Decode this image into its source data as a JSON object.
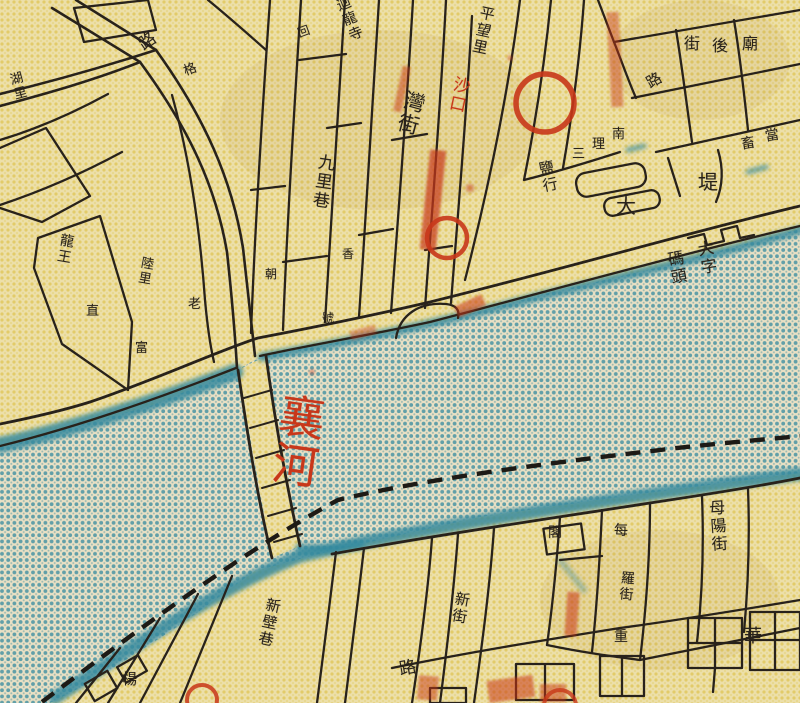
{
  "colors": {
    "paper": "#ecdfa9",
    "halftone_yellow_dot": "#dcbe3e",
    "river_base": "#e9e0c4",
    "river_dot_teal": "#3e8ea1",
    "bank_wash_teal": "#35899e",
    "ink_black": "#28221b",
    "annotation_red": "#c8371a"
  },
  "annotations": {
    "red_circles": [
      {
        "x": 545,
        "y": 103,
        "r": 29
      },
      {
        "x": 447,
        "y": 238,
        "r": 20
      },
      {
        "x": 202,
        "y": 700,
        "r": 15
      },
      {
        "x": 560,
        "y": 706,
        "r": 16
      }
    ]
  },
  "labels": [
    {
      "t": "路",
      "x": 136,
      "y": 40,
      "o": "h",
      "s": 17,
      "c": "ink",
      "r": -35
    },
    {
      "t": "回",
      "x": 296,
      "y": 28,
      "o": "h",
      "s": 12,
      "c": "ink",
      "r": -20
    },
    {
      "t": "迴龍寺",
      "x": 333,
      "y": 0,
      "o": "v",
      "s": 14,
      "c": "ink",
      "r": -22
    },
    {
      "t": "格",
      "x": 182,
      "y": 66,
      "o": "h",
      "s": 13,
      "c": "ink",
      "r": -20
    },
    {
      "t": "平望里",
      "x": 480,
      "y": 4,
      "o": "v",
      "s": 15,
      "c": "ink",
      "r": 12
    },
    {
      "t": "灣街",
      "x": 405,
      "y": 88,
      "o": "v",
      "s": 21,
      "c": "ink",
      "r": 15
    },
    {
      "t": "沙口",
      "x": 452,
      "y": 74,
      "o": "v",
      "s": 17,
      "c": "red",
      "r": 12
    },
    {
      "t": "九里巷",
      "x": 316,
      "y": 152,
      "o": "v",
      "s": 17,
      "c": "ink",
      "r": 8
    },
    {
      "t": "湖里",
      "x": 6,
      "y": 74,
      "o": "v",
      "s": 13,
      "c": "ink",
      "r": -15
    },
    {
      "t": "龍王",
      "x": 60,
      "y": 232,
      "o": "v",
      "s": 14,
      "c": "ink",
      "r": 10
    },
    {
      "t": "直",
      "x": 86,
      "y": 305,
      "o": "h",
      "s": 13,
      "c": "ink",
      "r": 0
    },
    {
      "t": "陸里",
      "x": 140,
      "y": 255,
      "o": "v",
      "s": 13,
      "c": "ink",
      "r": 10
    },
    {
      "t": "老",
      "x": 188,
      "y": 298,
      "o": "h",
      "s": 13,
      "c": "ink",
      "r": 0
    },
    {
      "t": "富",
      "x": 135,
      "y": 342,
      "o": "h",
      "s": 13,
      "c": "ink",
      "r": 0
    },
    {
      "t": "朝",
      "x": 265,
      "y": 268,
      "o": "h",
      "s": 12,
      "c": "ink",
      "r": 0
    },
    {
      "t": "香",
      "x": 342,
      "y": 248,
      "o": "h",
      "s": 12,
      "c": "ink",
      "r": 0
    },
    {
      "t": "號",
      "x": 322,
      "y": 312,
      "o": "h",
      "s": 12,
      "c": "ink",
      "r": 0
    },
    {
      "t": "街",
      "x": 684,
      "y": 36,
      "o": "h",
      "s": 16,
      "c": "ink",
      "r": 0
    },
    {
      "t": "後",
      "x": 712,
      "y": 38,
      "o": "h",
      "s": 16,
      "c": "ink",
      "r": 0
    },
    {
      "t": "廟",
      "x": 742,
      "y": 36,
      "o": "h",
      "s": 16,
      "c": "ink",
      "r": 0
    },
    {
      "t": "路",
      "x": 644,
      "y": 78,
      "o": "h",
      "s": 15,
      "c": "ink",
      "r": -30
    },
    {
      "t": "畜",
      "x": 740,
      "y": 138,
      "o": "h",
      "s": 14,
      "c": "ink",
      "r": -10
    },
    {
      "t": "當",
      "x": 764,
      "y": 130,
      "o": "h",
      "s": 14,
      "c": "ink",
      "r": -10
    },
    {
      "t": "南",
      "x": 612,
      "y": 128,
      "o": "h",
      "s": 13,
      "c": "ink",
      "r": 0
    },
    {
      "t": "理",
      "x": 592,
      "y": 138,
      "o": "h",
      "s": 13,
      "c": "ink",
      "r": 0
    },
    {
      "t": "三",
      "x": 572,
      "y": 148,
      "o": "h",
      "s": 13,
      "c": "ink",
      "r": 0
    },
    {
      "t": "鹽行",
      "x": 536,
      "y": 162,
      "o": "v",
      "s": 15,
      "c": "ink",
      "r": -12
    },
    {
      "t": "大",
      "x": 616,
      "y": 196,
      "o": "h",
      "s": 20,
      "c": "ink",
      "r": 0
    },
    {
      "t": "堤",
      "x": 698,
      "y": 172,
      "o": "h",
      "s": 20,
      "c": "ink",
      "r": 0
    },
    {
      "t": "大字",
      "x": 694,
      "y": 242,
      "o": "v",
      "s": 16,
      "c": "ink",
      "r": -10
    },
    {
      "t": "碼頭",
      "x": 664,
      "y": 252,
      "o": "v",
      "s": 16,
      "c": "ink",
      "r": -10
    },
    {
      "t": "襄河",
      "x": 278,
      "y": 390,
      "o": "v",
      "s": 46,
      "c": "red",
      "r": 8
    },
    {
      "t": "母陽街",
      "x": 706,
      "y": 500,
      "o": "v",
      "s": 16,
      "c": "ink",
      "r": -4
    },
    {
      "t": "閣",
      "x": 548,
      "y": 526,
      "o": "h",
      "s": 14,
      "c": "ink",
      "r": 0
    },
    {
      "t": "每",
      "x": 614,
      "y": 524,
      "o": "h",
      "s": 14,
      "c": "ink",
      "r": 0
    },
    {
      "t": "羅街",
      "x": 620,
      "y": 570,
      "o": "v",
      "s": 14,
      "c": "ink",
      "r": 5
    },
    {
      "t": "重",
      "x": 614,
      "y": 630,
      "o": "h",
      "s": 14,
      "c": "ink",
      "r": 0
    },
    {
      "t": "新壁巷",
      "x": 266,
      "y": 596,
      "o": "v",
      "s": 15,
      "c": "ink",
      "r": 12
    },
    {
      "t": "新街",
      "x": 455,
      "y": 590,
      "o": "v",
      "s": 15,
      "c": "ink",
      "r": 10
    },
    {
      "t": "路",
      "x": 398,
      "y": 662,
      "o": "h",
      "s": 17,
      "c": "ink",
      "r": -10
    },
    {
      "t": "華",
      "x": 744,
      "y": 628,
      "o": "h",
      "s": 18,
      "c": "ink",
      "r": 0
    },
    {
      "t": "楊",
      "x": 122,
      "y": 672,
      "o": "h",
      "s": 15,
      "c": "ink",
      "r": 0
    }
  ]
}
